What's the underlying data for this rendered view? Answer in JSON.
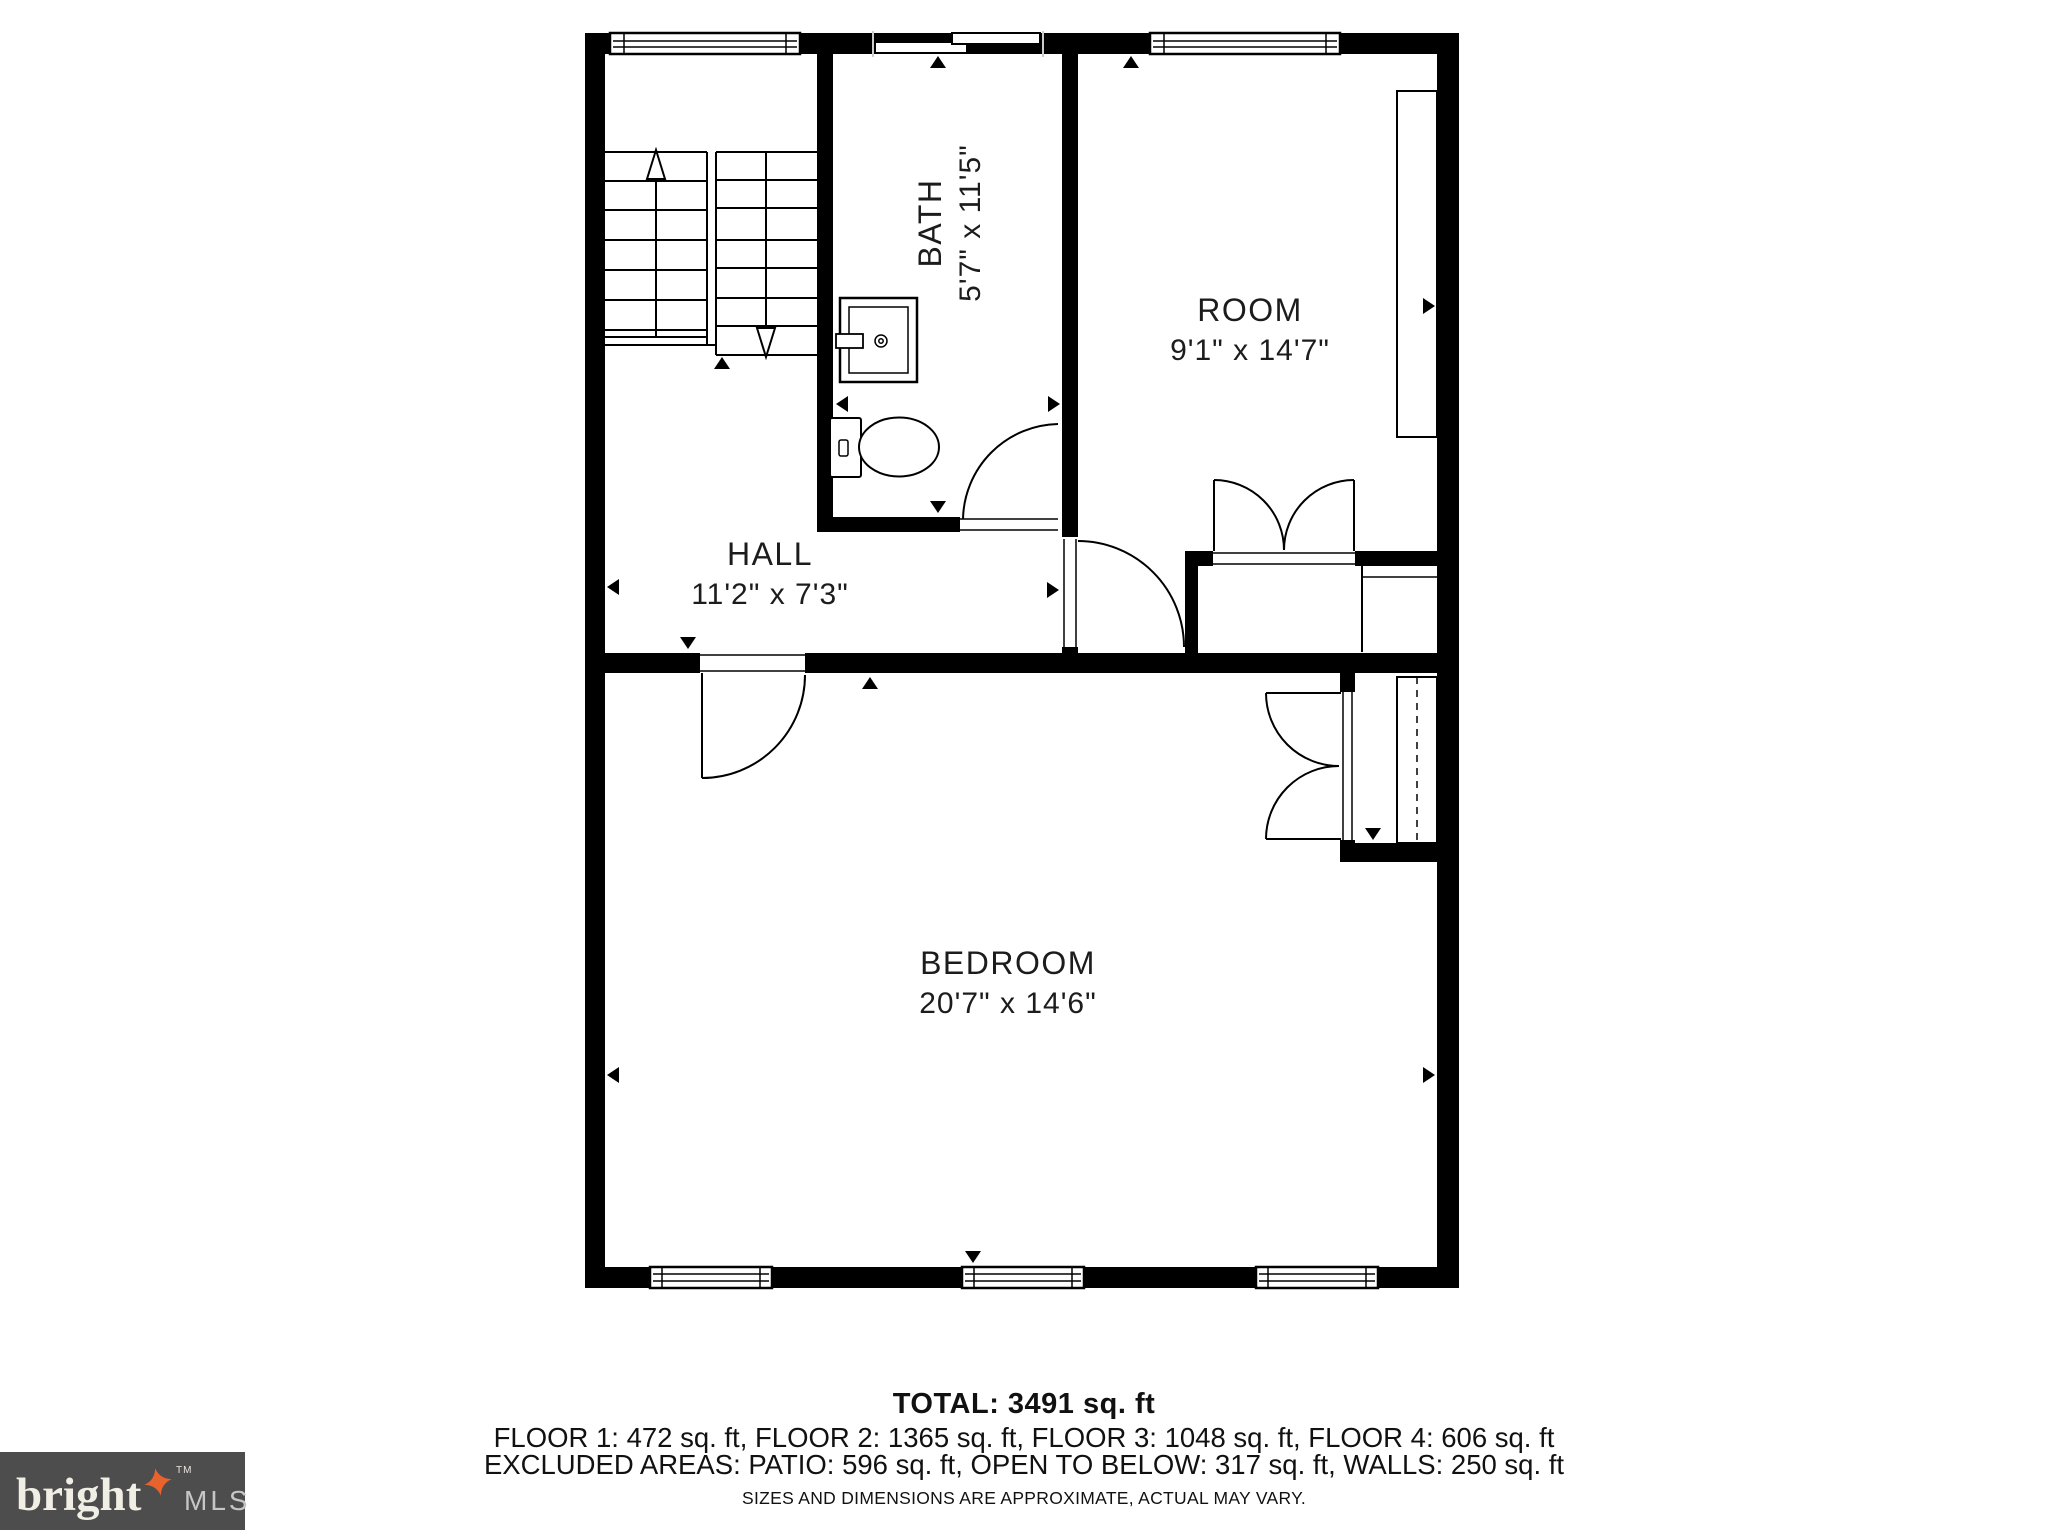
{
  "colors": {
    "wall": "#000000",
    "line": "#1a1a1a",
    "logo_bg": "#4D4D4D",
    "logo_text": "#F1EEE5",
    "logo_star": "#E8622D",
    "logo_mls": "#C6C6C6"
  },
  "rooms": {
    "bath": {
      "name": "BATH",
      "dims": "5'7\" x 11'5\""
    },
    "room": {
      "name": "ROOM",
      "dims": "9'1\" x 14'7\""
    },
    "hall": {
      "name": "HALL",
      "dims": "11'2\" x 7'3\""
    },
    "bedroom": {
      "name": "BEDROOM",
      "dims": "20'7\" x 14'6\""
    }
  },
  "footer": {
    "total": "TOTAL: 3491 sq. ft",
    "floors": "FLOOR 1: 472 sq. ft, FLOOR 2: 1365 sq. ft, FLOOR 3: 1048 sq. ft, FLOOR 4: 606 sq. ft",
    "excluded": "EXCLUDED AREAS: PATIO: 596 sq. ft, OPEN TO BELOW: 317 sq. ft, WALLS: 250 sq. ft",
    "disclaimer": "SIZES AND DIMENSIONS ARE APPROXIMATE, ACTUAL MAY VARY."
  },
  "logo": {
    "brand": "bright",
    "tm": "TM",
    "suffix": "MLS"
  }
}
